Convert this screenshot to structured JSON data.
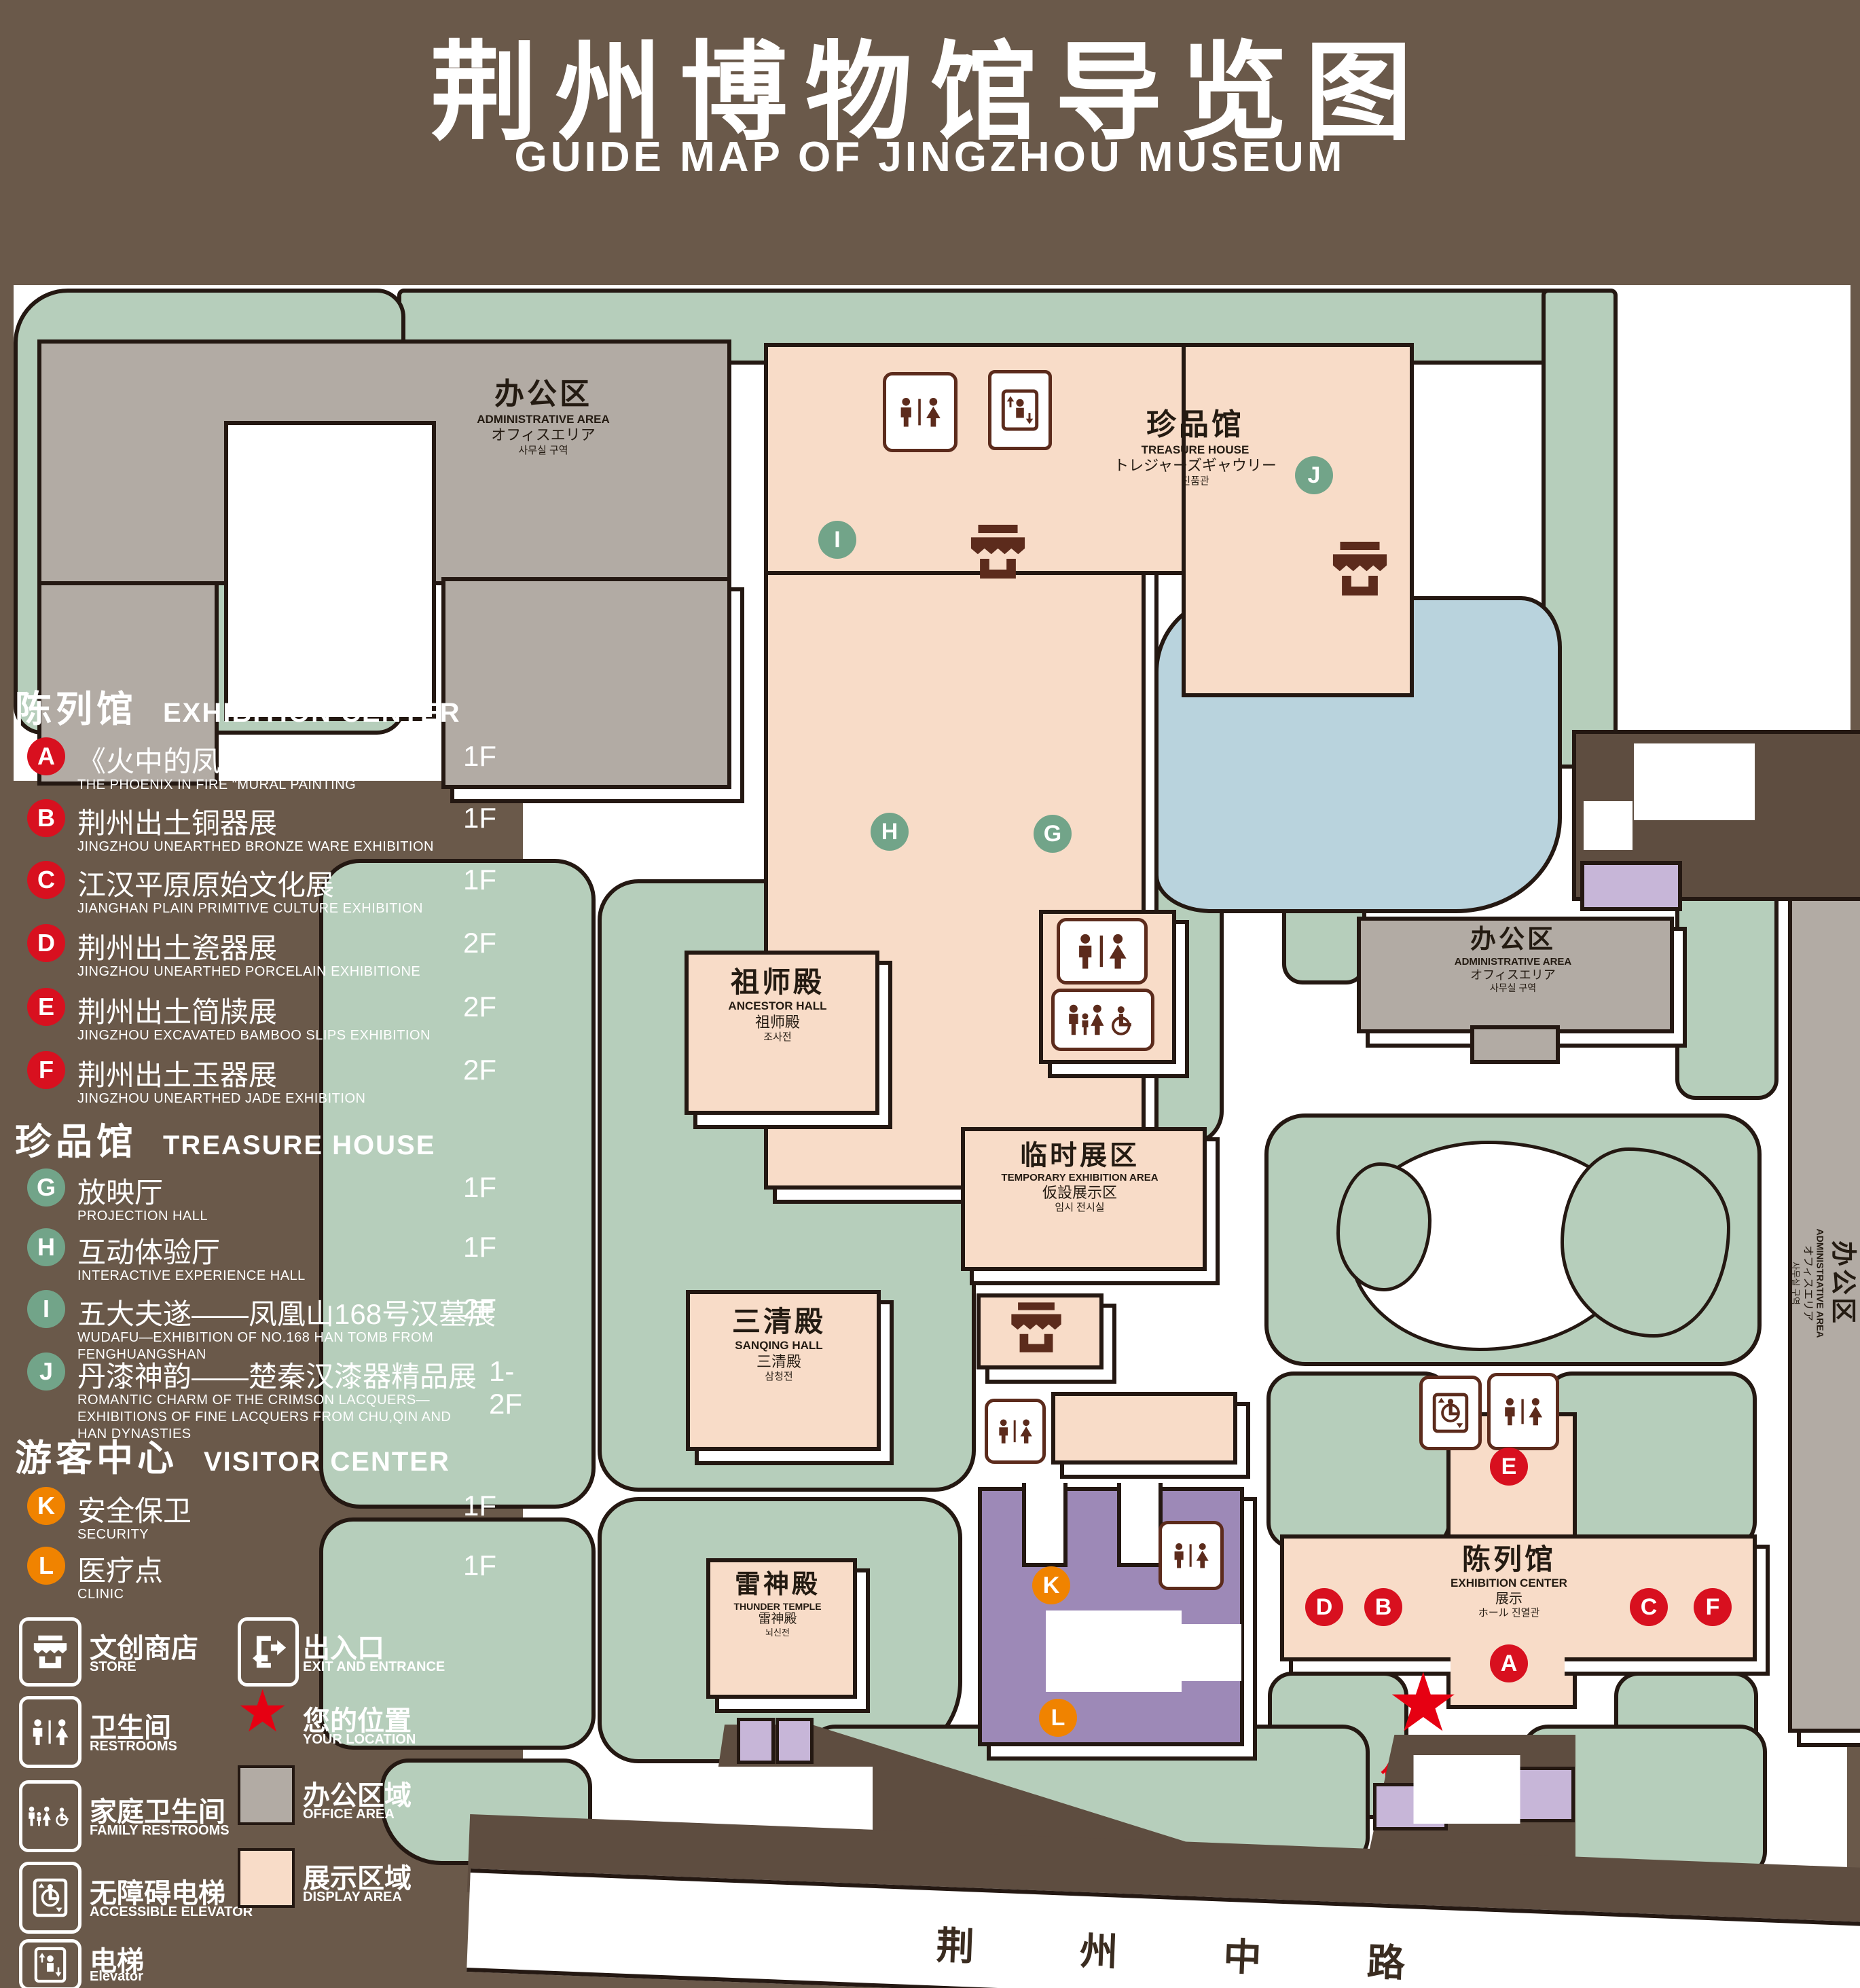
{
  "title": {
    "zh": "荆州博物馆导览图",
    "en": "GUIDE MAP OF JINGZHOU MUSEUM"
  },
  "colors": {
    "background": "#6a594a",
    "lawn": "#b6cebb",
    "display_area": "#f8dcc8",
    "office_area": "#b2aba4",
    "lake": "#b9d3dd",
    "visitor_center": "#9d89b7",
    "gate_purple": "#c7b6d8",
    "road_brown": "#5e4d40",
    "marker_red": "#d8101f",
    "marker_green": "#72a489",
    "marker_orange": "#f08300",
    "icon_brown": "#5c2b1c",
    "location_red": "#e60012"
  },
  "legend": {
    "sections": [
      {
        "zh": "陈列馆",
        "en": "EXHIBITION CENTER",
        "items": [
          {
            "letter": "A",
            "zh": "《火中的凤凰》壁画",
            "en": "THE PHOENIX IN FIRE \"MURAL PAINTING",
            "floor": "1F"
          },
          {
            "letter": "B",
            "zh": "荆州出土铜器展",
            "en": "JINGZHOU UNEARTHED BRONZE WARE EXHIBITION",
            "floor": "1F"
          },
          {
            "letter": "C",
            "zh": "江汉平原原始文化展",
            "en": "JIANGHAN PLAIN PRIMITIVE CULTURE EXHIBITION",
            "floor": "1F"
          },
          {
            "letter": "D",
            "zh": "荆州出土瓷器展",
            "en": "JINGZHOU UNEARTHED PORCELAIN EXHIBITIONE",
            "floor": "2F"
          },
          {
            "letter": "E",
            "zh": "荆州出土简牍展",
            "en": "JINGZHOU EXCAVATED BAMBOO SLIPS EXHIBITION",
            "floor": "2F"
          },
          {
            "letter": "F",
            "zh": "荆州出土玉器展",
            "en": "JINGZHOU UNEARTHED JADE EXHIBITION",
            "floor": "2F"
          }
        ]
      },
      {
        "zh": "珍品馆",
        "en": "TREASURE HOUSE",
        "items": [
          {
            "letter": "G",
            "zh": "放映厅",
            "en": "PROJECTION HALL",
            "floor": "1F"
          },
          {
            "letter": "H",
            "zh": "互动体验厅",
            "en": "INTERACTIVE EXPERIENCE HALL",
            "floor": "1F"
          },
          {
            "letter": "I",
            "zh": "五大夫遂——凤凰山168号汉墓展",
            "en": "WUDAFU—EXHIBITION OF NO.168 HAN TOMB FROM FENGHUANGSHAN",
            "floor": "2F"
          },
          {
            "letter": "J",
            "zh": "丹漆神韵——楚秦汉漆器精品展",
            "en": "ROMANTIC CHARM OF THE CRIMSON LACQUERS—EXHIBITIONS OF FINE LACQUERS FROM CHU,QIN AND HAN DYNASTIES",
            "floor": "1-2F"
          }
        ]
      },
      {
        "zh": "游客中心",
        "en": "VISITOR CENTER",
        "items": [
          {
            "letter": "K",
            "zh": "安全保卫",
            "en": "SECURITY",
            "floor": "1F"
          },
          {
            "letter": "L",
            "zh": "医疗点",
            "en": "CLINIC",
            "floor": "1F"
          }
        ]
      }
    ],
    "symbols": {
      "left": [
        {
          "icon": "store-icon",
          "zh": "文创商店",
          "en": "STORE"
        },
        {
          "icon": "restroom-icon",
          "zh": "卫生间",
          "en": "RESTROOMS"
        },
        {
          "icon": "family-restroom-icon",
          "zh": "家庭卫生间",
          "en": "FAMILY RESTROOMS"
        },
        {
          "icon": "accessible-elevator-icon",
          "zh": "无障碍电梯",
          "en": "ACCESSIBLE ELEVATOR"
        },
        {
          "icon": "elevator-icon",
          "zh": "电梯",
          "en": "Elevator"
        }
      ],
      "right": [
        {
          "icon": "exit-icon",
          "zh": "出入口",
          "en": "EXIT AND ENTRANCE"
        },
        {
          "icon": "location-star",
          "zh": "您的位置",
          "en": "YOUR LOCATION"
        },
        {
          "icon": "office-swatch",
          "zh": "办公区域",
          "en": "OFFICE AREA"
        },
        {
          "icon": "display-swatch",
          "zh": "展示区域",
          "en": "DISPLAY AREA"
        }
      ]
    }
  },
  "map": {
    "buildings": {
      "admin_tl": {
        "lines": [
          "办公区",
          "ADMINISTRATIVE AREA",
          "オフィスエリア",
          "사무실 구역"
        ]
      },
      "treasure": {
        "lines": [
          "珍品馆",
          "TREASURE HOUSE",
          "トレジャーズギャウリー",
          "진품관"
        ]
      },
      "ancestor": {
        "lines": [
          "祖师殿",
          "ANCESTOR HALL",
          "祖师殿",
          "조사전"
        ]
      },
      "sanqing": {
        "lines": [
          "三清殿",
          "SANQING HALL",
          "三清殿",
          "삼청전"
        ]
      },
      "thunder": {
        "lines": [
          "雷神殿",
          "THUNDER TEMPLE",
          "雷神殿",
          "뇌신전"
        ]
      },
      "temporary": {
        "lines": [
          "临时展区",
          "TEMPORARY EXHIBITION AREA",
          "仮設展示区",
          "임시 전시실"
        ]
      },
      "visitor": {
        "lines": [
          "游客中心",
          "VISITOR CENTER",
          "ビジターセンター",
          "관광객 센터"
        ]
      },
      "exhibition": {
        "lines": [
          "陈列馆",
          "EXHIBITION CENTER",
          "展示",
          "ホール 진열관"
        ]
      },
      "admin_r": {
        "lines": [
          "办公区",
          "ADMINISTRATIVE AREA",
          "オフィスエリア",
          "사무실 구역"
        ]
      },
      "admin_strip": {
        "lines": [
          "办公区",
          "ADMINISTRATIVE AREA",
          "オフィスエリア",
          "사무실 구역"
        ]
      },
      "gate": {
        "lines": [
          "开元观山门",
          "KAIYUAN TEMPLE GATE",
          "開元観山門",
          "산문을 열다"
        ]
      },
      "exit_mid": {
        "lines": [
          "出入口",
          "EXIT AND ENTRANCE",
          "出入口",
          "출입구"
        ]
      },
      "exit_br": {
        "lines": [
          "出入口",
          "EXIT AND ENTRANCE",
          "出入口",
          "출입구"
        ]
      }
    },
    "markers": [
      {
        "letter": "I",
        "color": "green"
      },
      {
        "letter": "J",
        "color": "green"
      },
      {
        "letter": "G",
        "color": "green"
      },
      {
        "letter": "H",
        "color": "green"
      },
      {
        "letter": "E",
        "color": "red"
      },
      {
        "letter": "D",
        "color": "red"
      },
      {
        "letter": "B",
        "color": "red"
      },
      {
        "letter": "C",
        "color": "red"
      },
      {
        "letter": "F",
        "color": "red"
      },
      {
        "letter": "A",
        "color": "red"
      },
      {
        "letter": "K",
        "color": "orange"
      },
      {
        "letter": "L",
        "color": "orange"
      }
    ],
    "your_location": "您的位置",
    "road": "荆 州 中 路"
  }
}
